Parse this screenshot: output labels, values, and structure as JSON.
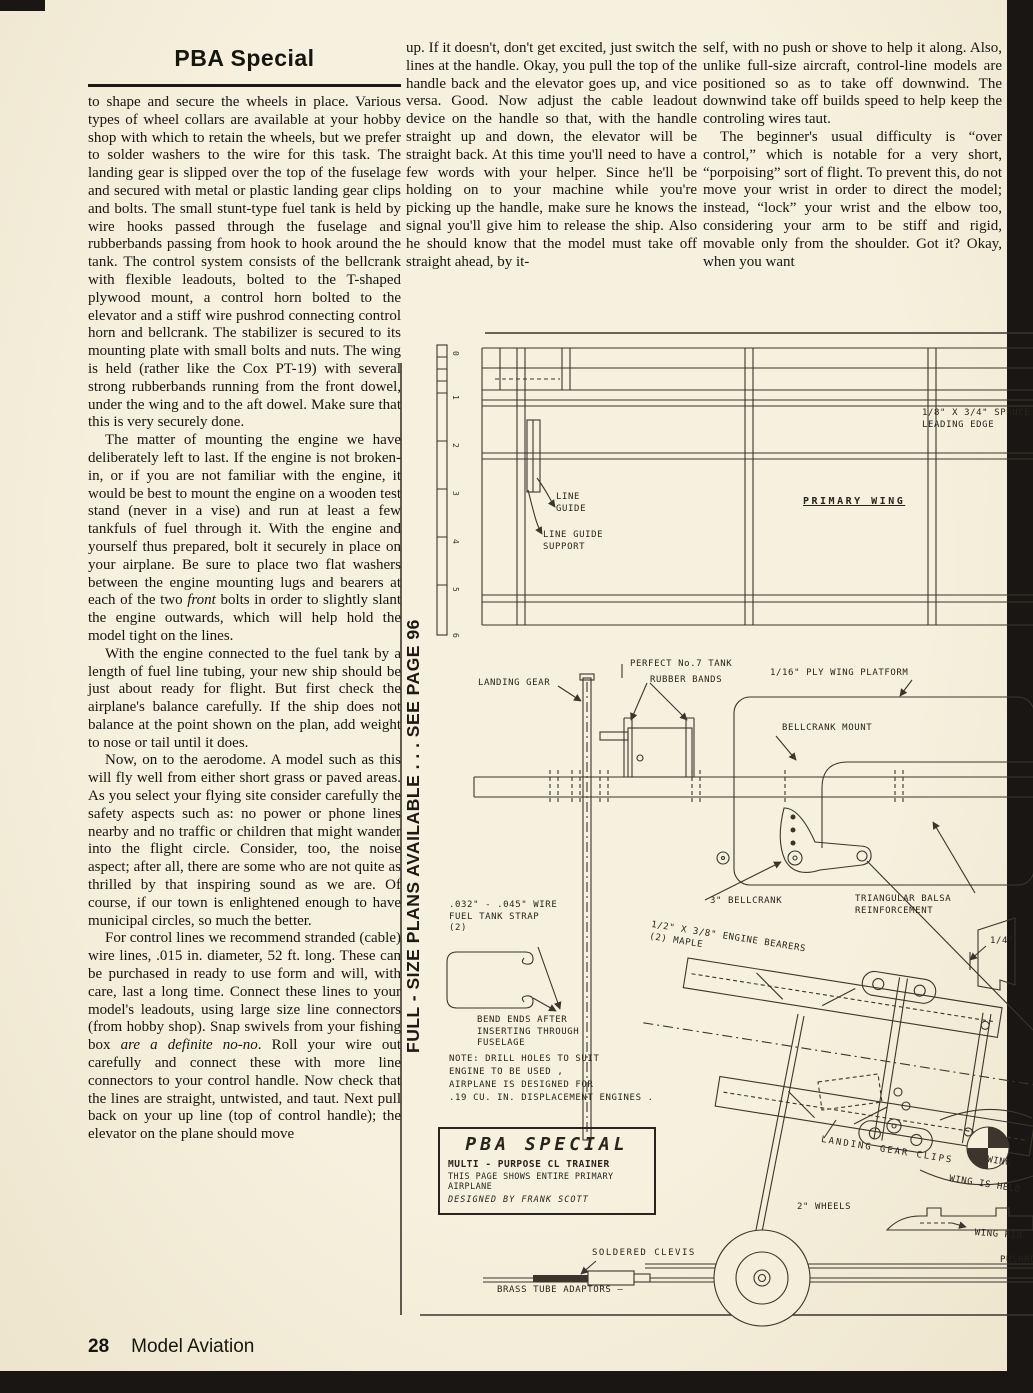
{
  "page": {
    "title": "PBA Special",
    "vertical_note": "FULL - SIZE PLANS AVAILABLE . . . SEE PAGE 96",
    "footer": {
      "page_number": "28",
      "magazine": "Model Aviation"
    }
  },
  "article": {
    "left_column": [
      {
        "indent": false,
        "segments": [
          {
            "t": "to shape and secure the wheels in place. Various types of wheel collars are available at your hobby shop with which to retain the wheels, but we prefer to solder washers to the wire for this task. The landing gear is slipped over the top of the fuselage and secured with metal or plastic landing gear clips and bolts. The small stunt-type fuel tank is held by wire hooks passed through the fuselage and rubberbands passing from hook to hook around the tank. The control system consists of the bellcrank with flexible leadouts, bolted to the T-shaped plywood mount, a control horn bolted to the elevator and a stiff wire pushrod connecting control horn and bellcrank. The stabilizer is secured to its mounting plate with small bolts and nuts. The wing is held (rather like the Cox PT-19) with several strong rubberbands running from the front dowel, under the wing and to the aft dowel. Make sure that this is very securely done."
          }
        ]
      },
      {
        "indent": true,
        "segments": [
          {
            "t": "The matter of mounting the engine we have deliberately left to last. If the engine is not broken-in, or if you are not familiar with the engine, it would be best to mount the engine on a wooden test stand (never in a vise) and run at least a few tankfuls of fuel through it. With the engine and yourself thus prepared, bolt it securely in place on your airplane. Be sure to place two flat washers between the engine mounting lugs and bearers at each of the two "
          },
          {
            "t": "front",
            "i": true
          },
          {
            "t": " bolts in order to slightly slant the engine outwards, which will help hold the model tight on the lines."
          }
        ]
      },
      {
        "indent": true,
        "segments": [
          {
            "t": "With the engine connected to the fuel tank by a length of fuel line tubing, your new ship should be just about ready for flight. But first check the airplane's balance carefully. If the ship does not balance at the point shown on the plan, add weight to nose or tail until it does."
          }
        ]
      },
      {
        "indent": true,
        "segments": [
          {
            "t": "Now, on to the aerodome. A model such as this will fly well from either short grass or paved areas. As you select your flying site consider carefully the safety aspects such as: no power or phone lines nearby and no traffic or children that might wander into the flight circle. Consider, too, the noise aspect; after all, there are some who are not quite as thrilled by that inspiring sound as we are. Of course, if our town is enlightened enough to have municipal circles, so much the better."
          }
        ]
      },
      {
        "indent": true,
        "segments": [
          {
            "t": "For control lines we recommend stranded (cable) wire lines, .015 in. diameter, 52 ft. long. These can be purchased in ready to use form and will, with care, last a long time. Connect these lines to your model's leadouts, using large size line connectors (from hobby shop). Snap swivels from your fishing box "
          },
          {
            "t": "are a definite no-no",
            "i": true
          },
          {
            "t": ". Roll your wire out carefully and connect these with more line connectors to your control handle. Now check that the lines are straight, untwisted, and taut. Next pull back on your up line (top of control handle); the elevator on the plane should move"
          }
        ]
      }
    ],
    "middle_column": [
      {
        "indent": false,
        "segments": [
          {
            "t": "up. If it doesn't, don't get excited, just switch the lines at the handle. Okay, you pull the top of the handle back and the elevator goes up, and vice versa. Good. Now adjust the cable leadout device on the handle so that, with the handle straight up and down, the elevator will be straight back. At this time you'll need to have a few words with your helper. Since he'll be holding on to your machine while you're picking up the handle, make sure he knows the signal you'll give him to release the ship. Also he should know that the model must take off straight ahead, by it-"
          }
        ]
      }
    ],
    "right_column": [
      {
        "indent": false,
        "segments": [
          {
            "t": "self, with no push or shove to help it along. Also, unlike full-size aircraft, control-line models are positioned so as to take off downwind. The downwind take off builds speed to help keep the controling wires taut."
          }
        ]
      },
      {
        "indent": true,
        "segments": [
          {
            "t": "The beginner's usual difficulty is “over control,” which is notable for a very short, “porpoising” sort of flight. To prevent this, do not move your wrist in order to direct the model; instead, “lock” your wrist and the elbow too, considering your arm to be stiff and rigid, movable only from the shoulder. Got it? Okay, when you want"
          }
        ]
      }
    ]
  },
  "plan": {
    "ruler": [
      "0",
      "1",
      "2",
      "3",
      "4",
      "5",
      "6"
    ],
    "labels": {
      "spruce_leading_edge": "1/8\" X 3/4\" SPRUCE\nLEADING EDGE",
      "primary_wing": "PRIMARY WING",
      "line_guide": "LINE\nGUIDE",
      "line_guide_support": "LINE GUIDE\nSUPPORT",
      "landing_gear": "LANDING GEAR",
      "perfect_tank": "PERFECT No.7 TANK",
      "rubber_bands": "RUBBER BANDS",
      "ply_wing_platform": "1/16\" PLY WING PLATFORM",
      "bellcrank_mount": "BELLCRANK MOUNT",
      "bellcrank_3": "3\" BELLCRANK",
      "triangular_balsa": "TRIANGULAR BALSA\nREINFORCEMENT",
      "quarter_inch": "1/4\"",
      "fuel_tank_strap": ".032\" - .045\" WIRE\nFUEL TANK STRAP\n(2)",
      "bend_ends": "BEND ENDS AFTER\nINSERTING THROUGH\nFUSELAGE",
      "note": "NOTE: DRILL HOLES TO SUIT\nENGINE TO BE USED ,\nAIRPLANE IS DESIGNED FOR\n.19 CU. IN. DISPLACEMENT ENGINES .",
      "engine_bearers": "1/2\" X 3/8\" ENGINE BEARERS\n(2) MAPLE",
      "landing_gear_clips": "LANDING GEAR CLIPS",
      "wing": "WING",
      "wing_is_held": "WING IS HELD",
      "wheels_2": "2\" WHEELS",
      "wing_rib": "WING RIB",
      "pushrod": "PUSHROD",
      "soldered_clevis": "SOLDERED CLEVIS",
      "brass_tube_adaptors": "BRASS TUBE ADAPTORS —"
    },
    "title_box": {
      "title": "PBA SPECIAL",
      "line1": "MULTI - PURPOSE CL TRAINER",
      "line2": "THIS PAGE SHOWS ENTIRE PRIMARY AIRPLANE",
      "line3": "DESIGNED BY FRANK SCOTT"
    }
  }
}
